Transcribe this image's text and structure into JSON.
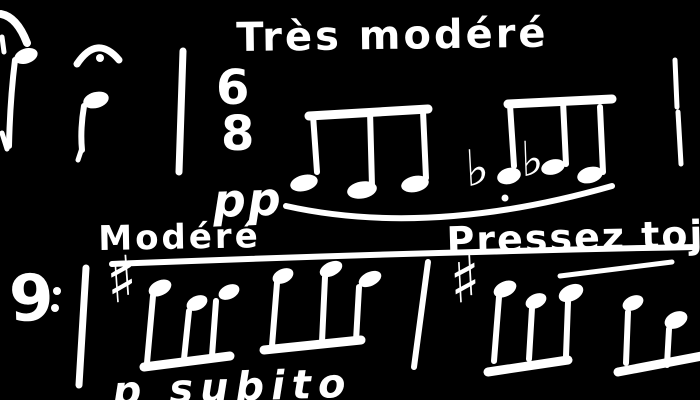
{
  "colors": {
    "background": "#000000",
    "ink": "#ffffff"
  },
  "markings": {
    "tempo_top": "Très modéré",
    "dynamic_top": "pp",
    "tempo_mid": "Modéré",
    "expression": "Pressez tojo",
    "dynamic_bottom": "p subito"
  },
  "time_signature": {
    "numerator": "6",
    "denominator": "8"
  },
  "glyphs": {
    "bass_clef": "9",
    "sharp": "♯",
    "flat": "♭"
  },
  "notation_summary": {
    "clef": "bass",
    "time_signature": "6/8",
    "beamed_note_groups_top_staff": 2,
    "beamed_note_groups_bottom_staff": 4,
    "single_notes_top_left": 2,
    "accidentals_in_order": [
      "sharp",
      "flat",
      "flat",
      "sharp"
    ],
    "has_fermata": true,
    "has_phrase_slur": true
  }
}
